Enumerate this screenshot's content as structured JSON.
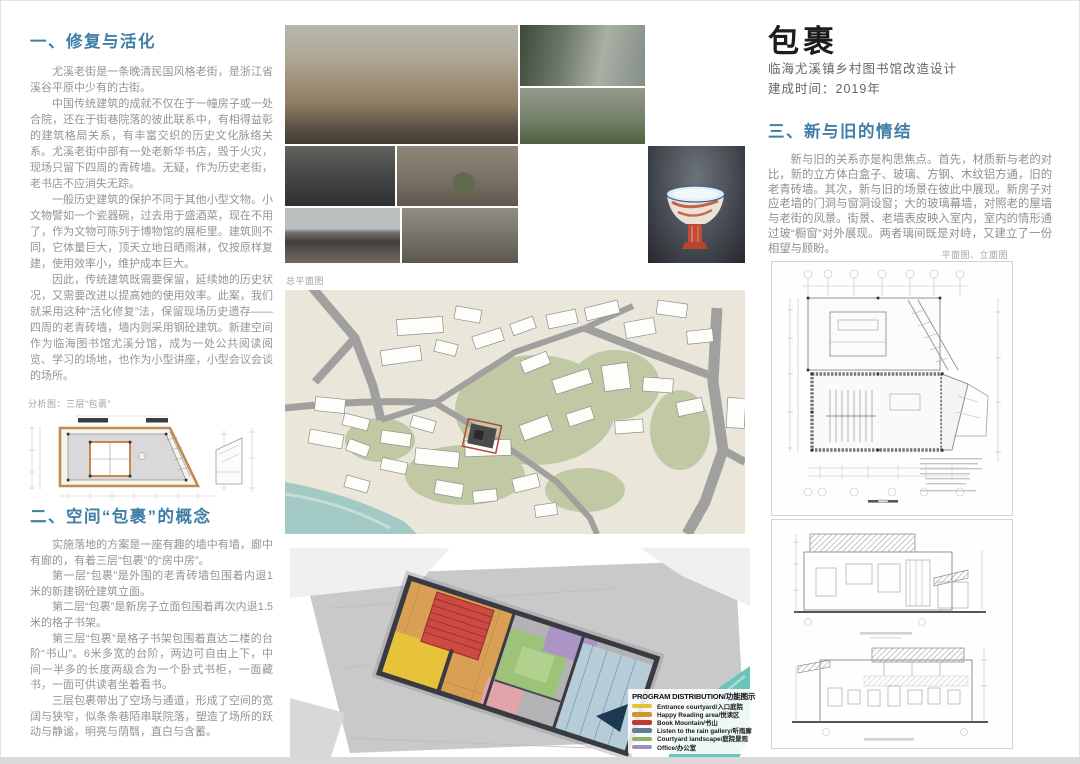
{
  "poster": {
    "title": "包裹",
    "subtitle": "临海尤溪镇乡村图书馆改造设计",
    "completion": "建成时间：2019年"
  },
  "left": {
    "section1": {
      "heading": "一、修复与活化",
      "paragraphs": [
        "尤溪老街是一条晚清民国风格老街，是浙江省溪谷平原中少有的古街。",
        "中国传统建筑的成就不仅在于一幢房子或一处合院，还在于街巷院落的彼此联系中，有相得益彰的建筑格局关系，有丰富交织的历史文化脉络关系。尤溪老街中部有一处老新华书店，毁于火灾，现场只留下四周的青砖墙。无疑，作为历史老街，老书店不应消失无踪。",
        "一般历史建筑的保护不同于其他小型文物。小文物譬如一个瓷器碗，过去用于盛酒菜，现在不用了，作为文物可陈列于博物馆的展柜里。建筑则不同，它体量巨大，顶天立地日晒雨淋，仅按原样复建，使用效率小，维护成本巨大。",
        "因此，传统建筑既需要保留，延续她的历史状况，又需要改进以提高她的使用效率。此案，我们就采用这种“活化修复”法，保留现场历史遗存——四周的老青砖墙，墙内则采用钢砼建筑。新建空间作为临海图书馆尤溪分馆，成为一处公共阅读阅览、学习的场地，也作为小型讲座，小型会议会谈的场所。"
      ]
    },
    "analysis_caption": "分析图：三层“包裹”",
    "section2": {
      "heading": "二、空间“包裹”的概念",
      "paragraphs": [
        "实施落地的方案是一座有趣的墙中有墙，廊中有廊的，有着三层“包裹”的“房中房”。",
        "第一层“包裹”是外围的老青砖墙包围着内退1米的新建钢砼建筑立面。",
        "第二层“包裹”是新房子立面包围着再次内退1.5米的格子书架。",
        "第三层“包裹”是格子书架包围着直达二楼的台阶“书山”。6米多宽的台阶，两边可自由上下，中间一半多的长度两级合为一个卧式书柜，一面藏书，一面可供读者坐着看书。",
        "三层包裹带出了空场与通道，形成了空间的宽阔与狭窄，似条条巷陌串联院落，塑造了场所的跃动与静谧，明亮与荫翳，直白与含蓄。"
      ]
    }
  },
  "middle": {
    "site_plan_label": "总平面图",
    "legend": {
      "title": "PROGRAM DISTRIBUTION/功能图示",
      "items": [
        {
          "label": "Entrance courtyard/入口庭院",
          "color": "#e5c136"
        },
        {
          "label": "Happy Reading area/悦读区",
          "color": "#d0952c"
        },
        {
          "label": "Book Mountain/书山",
          "color": "#bf3a30"
        },
        {
          "label": "Listen to the rain gallery/听雨廊",
          "color": "#5d7f97"
        },
        {
          "label": "Courtyard landscape/庭院景观",
          "color": "#8cb264"
        },
        {
          "label": "Office/办公室",
          "color": "#a08fc0"
        }
      ]
    }
  },
  "right": {
    "section3": {
      "heading": "三、新与旧的情结",
      "paragraphs": [
        "新与旧的关系亦是构思焦点。首先，材质新与老的对比，新的立方体白盒子、玻璃、方钢、木纹铝方通，旧的老青砖墙。其次，新与旧的场景在彼此中展现。新房子对应老墙的门洞与窗洞设窗；大的玻璃幕墙，对照老的屋墙与老街的风景。街景、老墙表皮映入室内，室内的情形通过玻“橱窗”对外展现。两者璃间既是对峙，又建立了一份相望与顾盼。"
      ]
    },
    "drawings_label": "平面图、立面图"
  },
  "colors": {
    "heading_blue": "#3f7ea6",
    "wall_orange": "#c08a52",
    "site_red_marker": "#b5473c"
  }
}
